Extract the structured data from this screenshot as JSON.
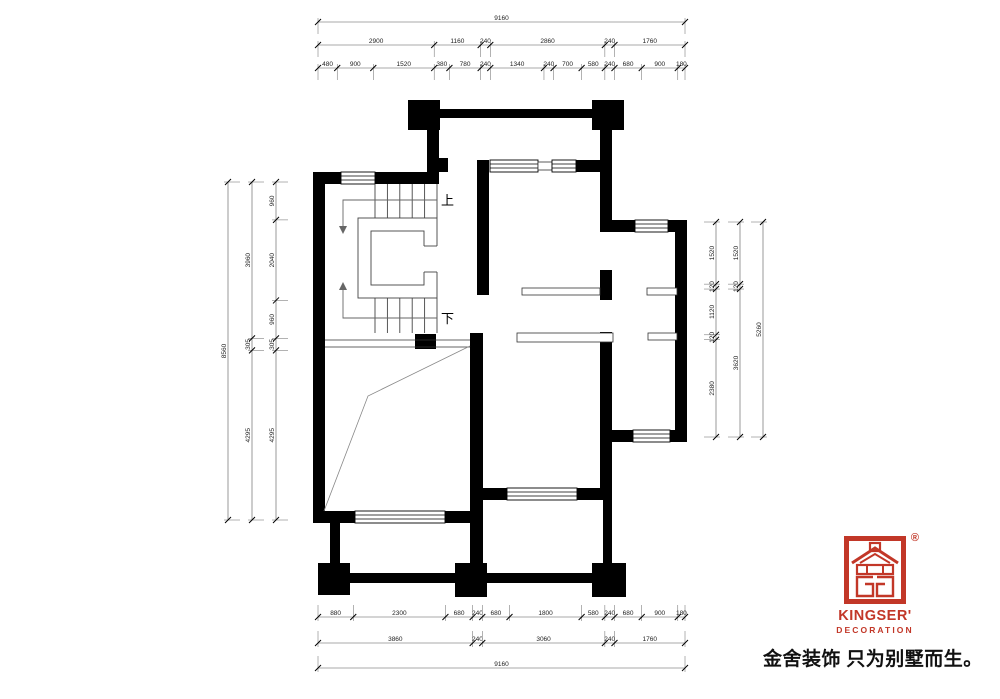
{
  "plan": {
    "stair_up_label": "上",
    "stair_down_label": "下"
  },
  "dimensions": {
    "top": {
      "row1": [
        "9160"
      ],
      "row2": [
        "2900",
        "1160",
        "240",
        "2860",
        "240",
        "1760"
      ],
      "row3": [
        "480",
        "900",
        "1520",
        "380",
        "780",
        "240",
        "1340",
        "240",
        "700",
        "580",
        "240",
        "680",
        "900",
        "180"
      ]
    },
    "bottom": {
      "row1": [
        "880",
        "2300",
        "680",
        "240",
        "680",
        "1800",
        "580",
        "240",
        "680",
        "900",
        "180"
      ],
      "row2": [
        "3860",
        "240",
        "3060",
        "240",
        "1760"
      ],
      "row3": [
        "9160"
      ]
    },
    "left": {
      "outer": [
        "8560"
      ],
      "middle": [
        "3960",
        "305",
        "4295"
      ],
      "inner": [
        "960",
        "2040",
        "960",
        "305",
        "4295"
      ]
    },
    "right": {
      "inner": [
        "1520",
        "120",
        "1120",
        "120",
        "2380"
      ],
      "middle": [
        "1520",
        "120",
        "3620"
      ],
      "outer": [
        "5260"
      ]
    }
  },
  "logo": {
    "brand": "KINGSER'",
    "subtitle": "DECORATION",
    "registered": "®",
    "tagline": "金舍装饰 只为别墅而生。",
    "accent_color": "#c23728"
  }
}
